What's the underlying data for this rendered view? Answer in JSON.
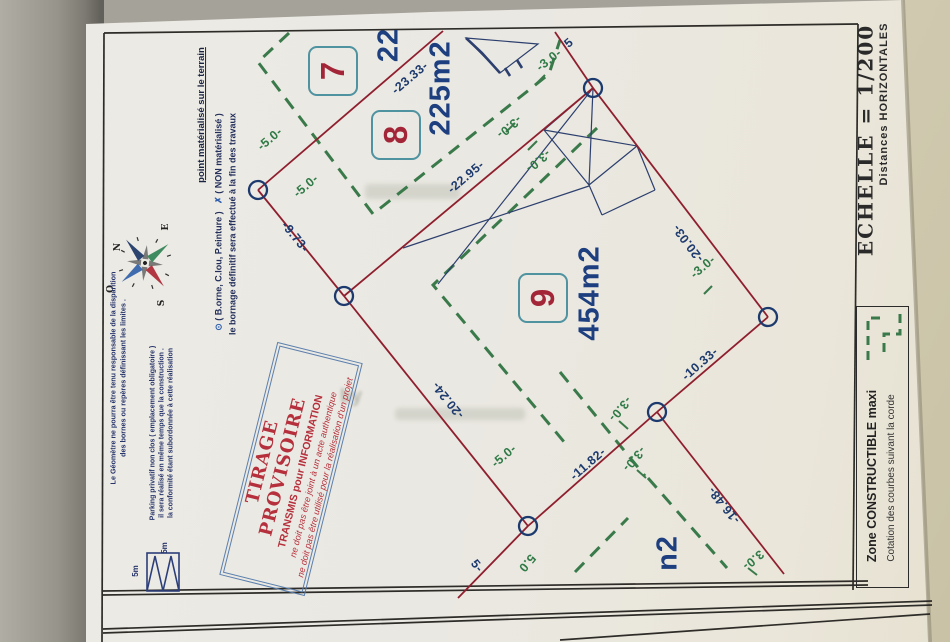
{
  "scale_panel": {
    "echelle": "ECHELLE  =  1/200",
    "distances": "Distances  HORIZONTALES"
  },
  "zone_legend": {
    "title": "Zone  CONSTRUCTIBLE  maxi",
    "subtitle": "Cotation des courbes suivant la corde",
    "dash_color": "#3a7a4a"
  },
  "marker_legend": {
    "line1": "point matérialisé sur le terrain",
    "marker1_symbol": "⊙",
    "marker1_text": "( B.orne, C.lou, P.einture )",
    "marker2_symbol": "✗",
    "marker2_text": "( NON matérialisé )",
    "line3": "le bornage définitif sera effectué à la fin des travaux"
  },
  "disclaimer": {
    "line1": "Le Géomètre ne pourra être tenu responsable de la disparition",
    "line2": "des bornes ou repères définissant les limites ."
  },
  "parking_note": {
    "line1": "Parking privatif non clos ( emplacement obligatoire )",
    "line2": "il sera réalisé en même temps que la construction .",
    "line3": "la conformité étant subordonnée à cette réalisation",
    "dim_label_1": "5m",
    "dim_label_2": "5m"
  },
  "compass": {
    "n": "N",
    "e": "E",
    "s": "S",
    "o": "O"
  },
  "stamp": {
    "title": "TIRAGE  PROVISOIRE",
    "line2": "TRANSMIS pour INFORMATION",
    "line3": "ne doit pas être joint à un acte authentique",
    "line4": "ne doit pas être utilisé pour la réalisation d'un projet",
    "text_color": "#b5303c",
    "border_color": "#5b7fae"
  },
  "plots": [
    {
      "number": "7",
      "x": 333,
      "y": 71
    },
    {
      "number": "8",
      "x": 396,
      "y": 135
    },
    {
      "number": "9",
      "x": 543,
      "y": 298
    }
  ],
  "areas": [
    {
      "text": "225m2",
      "x": 441,
      "y": 88
    },
    {
      "text": "454m2",
      "x": 590,
      "y": 293
    },
    {
      "text": "22",
      "x": 389,
      "y": 45
    },
    {
      "text": "n2",
      "x": 668,
      "y": 553
    }
  ],
  "measurements": [
    {
      "text": "-23.33-",
      "x": 410,
      "y": 78,
      "rot": -40,
      "c": "b"
    },
    {
      "text": "-22.95-",
      "x": 466,
      "y": 177,
      "rot": -40,
      "c": "b"
    },
    {
      "text": "-9.73-",
      "x": 295,
      "y": 237,
      "rot": 51,
      "c": "b"
    },
    {
      "text": "-20.24-",
      "x": 448,
      "y": 400,
      "rot": 231,
      "c": "b"
    },
    {
      "text": "-20.03-",
      "x": 688,
      "y": 243,
      "rot": 233,
      "c": "b"
    },
    {
      "text": "-10.33-",
      "x": 700,
      "y": 364,
      "rot": -41,
      "c": "b"
    },
    {
      "text": "-11.82-",
      "x": 588,
      "y": 464,
      "rot": -41,
      "c": "b"
    },
    {
      "text": "-16.48-",
      "x": 724,
      "y": 505,
      "rot": 231,
      "c": "b"
    },
    {
      "text": "5",
      "x": 569,
      "y": 43,
      "rot": -40,
      "c": "b"
    },
    {
      "text": "5-",
      "x": 477,
      "y": 566,
      "rot": 51,
      "c": "b"
    },
    {
      "text": "-5.0-",
      "x": 270,
      "y": 139,
      "rot": -40,
      "c": "g"
    },
    {
      "text": "-5.0-",
      "x": 306,
      "y": 186,
      "rot": -40,
      "c": "g"
    },
    {
      "text": "-3.0-",
      "x": 549,
      "y": 60,
      "rot": -38,
      "c": "g"
    },
    {
      "text": "-3.0-",
      "x": 509,
      "y": 127,
      "rot": 140,
      "c": "g"
    },
    {
      "text": "-3.0-",
      "x": 538,
      "y": 161,
      "rot": 140,
      "c": "g"
    },
    {
      "text": "-3.0-",
      "x": 703,
      "y": 267,
      "rot": -40,
      "c": "g"
    },
    {
      "text": "-3.0-",
      "x": 620,
      "y": 409,
      "rot": 130,
      "c": "g"
    },
    {
      "text": "-3.0-",
      "x": 634,
      "y": 459,
      "rot": 130,
      "c": "g"
    },
    {
      "text": "3.0-",
      "x": 753,
      "y": 560,
      "rot": 140,
      "c": "g"
    },
    {
      "text": "-5.0-",
      "x": 504,
      "y": 456,
      "rot": -40,
      "c": "g"
    },
    {
      "text": "5.0",
      "x": 527,
      "y": 563,
      "rot": 130,
      "c": "g"
    }
  ],
  "colors": {
    "boundary_red": "#8f1f2e",
    "zone_green": "#3a7a4a",
    "measure_blue": "#1d3a6e",
    "building_navy": "#2c3f6e",
    "plot_box_teal": "#4f93a0",
    "plot_number_red": "#a32638"
  },
  "watermark": {
    "partial_text": "by"
  }
}
